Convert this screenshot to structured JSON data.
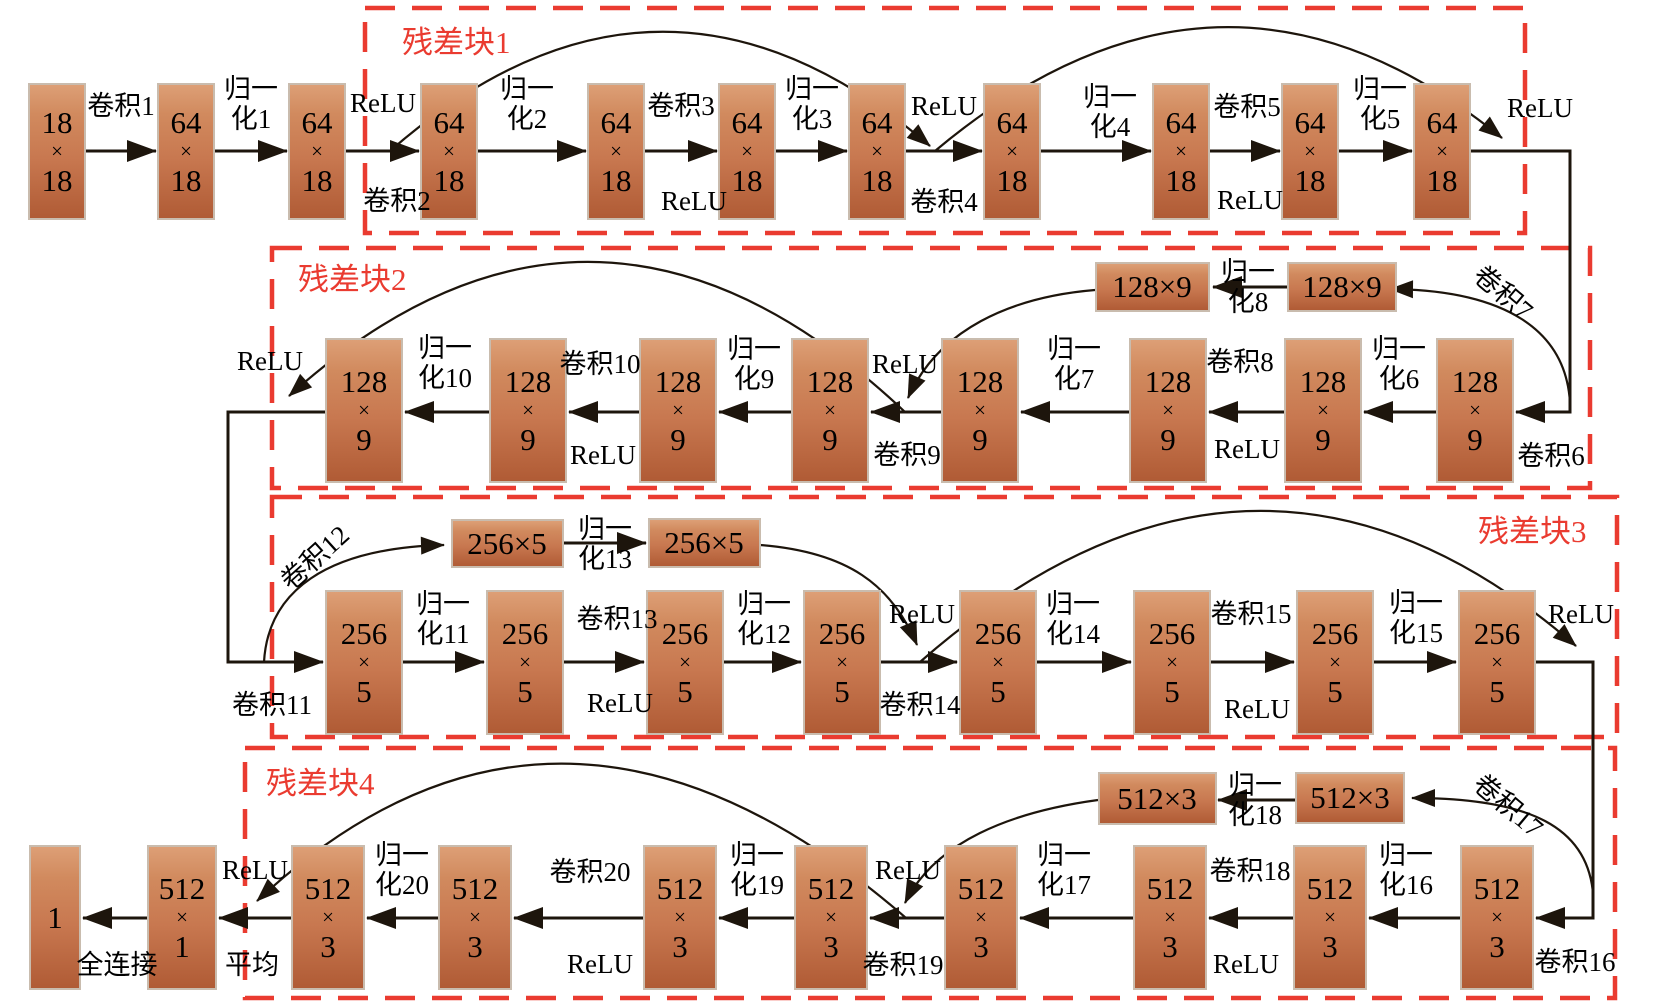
{
  "diagram": {
    "canvas": {
      "width": 1654,
      "height": 1004,
      "background": "#ffffff"
    },
    "colors": {
      "block_gradient_top": "#dd9f76",
      "block_gradient_bottom": "#b05b35",
      "residual_box_red": "#ea3b30",
      "wire_black": "#1d150c"
    },
    "boxes": [
      {
        "label": "残差块1",
        "x": 365,
        "y": 8,
        "w": 1160,
        "h": 225,
        "lx": 402,
        "ly": 27
      },
      {
        "label": "残差块2",
        "x": 272,
        "y": 248,
        "w": 1318,
        "h": 240,
        "lx": 298,
        "ly": 264
      },
      {
        "label": "残差块3",
        "x": 272,
        "y": 497,
        "w": 1345,
        "h": 240,
        "lx": 1478,
        "ly": 516
      },
      {
        "label": "残差块4",
        "x": 245,
        "y": 748,
        "w": 1370,
        "h": 250,
        "lx": 266,
        "ly": 768
      }
    ],
    "nodes": [
      {
        "lines": [
          "18",
          "×",
          "18"
        ],
        "cx": 57,
        "top": 83,
        "w": 58,
        "h": 137
      },
      {
        "lines": [
          "64",
          "×",
          "18"
        ],
        "cx": 186,
        "top": 83,
        "w": 58,
        "h": 137
      },
      {
        "lines": [
          "64",
          "×",
          "18"
        ],
        "cx": 317,
        "top": 83,
        "w": 58,
        "h": 137
      },
      {
        "lines": [
          "64",
          "×",
          "18"
        ],
        "cx": 449,
        "top": 83,
        "w": 58,
        "h": 137
      },
      {
        "lines": [
          "64",
          "×",
          "18"
        ],
        "cx": 616,
        "top": 83,
        "w": 58,
        "h": 137
      },
      {
        "lines": [
          "64",
          "×",
          "18"
        ],
        "cx": 747,
        "top": 83,
        "w": 58,
        "h": 137
      },
      {
        "lines": [
          "64",
          "×",
          "18"
        ],
        "cx": 877,
        "top": 83,
        "w": 58,
        "h": 137
      },
      {
        "lines": [
          "64",
          "×",
          "18"
        ],
        "cx": 1012,
        "top": 83,
        "w": 58,
        "h": 137
      },
      {
        "lines": [
          "64",
          "×",
          "18"
        ],
        "cx": 1181,
        "top": 83,
        "w": 58,
        "h": 137
      },
      {
        "lines": [
          "64",
          "×",
          "18"
        ],
        "cx": 1310,
        "top": 83,
        "w": 58,
        "h": 137
      },
      {
        "lines": [
          "64",
          "×",
          "18"
        ],
        "cx": 1442,
        "top": 83,
        "w": 58,
        "h": 137
      },
      {
        "lines": [
          "128",
          "×",
          "9"
        ],
        "cx": 364,
        "top": 338,
        "w": 78,
        "h": 145
      },
      {
        "lines": [
          "128",
          "×",
          "9"
        ],
        "cx": 528,
        "top": 338,
        "w": 78,
        "h": 145
      },
      {
        "lines": [
          "128",
          "×",
          "9"
        ],
        "cx": 678,
        "top": 338,
        "w": 78,
        "h": 145
      },
      {
        "lines": [
          "128",
          "×",
          "9"
        ],
        "cx": 830,
        "top": 338,
        "w": 78,
        "h": 145
      },
      {
        "lines": [
          "128",
          "×",
          "9"
        ],
        "cx": 980,
        "top": 338,
        "w": 78,
        "h": 145
      },
      {
        "lines": [
          "128",
          "×",
          "9"
        ],
        "cx": 1168,
        "top": 338,
        "w": 78,
        "h": 145
      },
      {
        "lines": [
          "128",
          "×",
          "9"
        ],
        "cx": 1323,
        "top": 338,
        "w": 78,
        "h": 145
      },
      {
        "lines": [
          "128",
          "×",
          "9"
        ],
        "cx": 1475,
        "top": 338,
        "w": 78,
        "h": 145
      },
      {
        "lines": [
          "128×9"
        ],
        "cx": 1152,
        "top": 262,
        "w": 115,
        "h": 50
      },
      {
        "lines": [
          "128×9"
        ],
        "cx": 1342,
        "top": 262,
        "w": 110,
        "h": 50
      },
      {
        "lines": [
          "256",
          "×",
          "5"
        ],
        "cx": 364,
        "top": 590,
        "w": 78,
        "h": 145
      },
      {
        "lines": [
          "256",
          "×",
          "5"
        ],
        "cx": 525,
        "top": 590,
        "w": 78,
        "h": 145
      },
      {
        "lines": [
          "256",
          "×",
          "5"
        ],
        "cx": 685,
        "top": 590,
        "w": 78,
        "h": 145
      },
      {
        "lines": [
          "256",
          "×",
          "5"
        ],
        "cx": 842,
        "top": 590,
        "w": 78,
        "h": 145
      },
      {
        "lines": [
          "256",
          "×",
          "5"
        ],
        "cx": 998,
        "top": 590,
        "w": 78,
        "h": 145
      },
      {
        "lines": [
          "256",
          "×",
          "5"
        ],
        "cx": 1172,
        "top": 590,
        "w": 78,
        "h": 145
      },
      {
        "lines": [
          "256",
          "×",
          "5"
        ],
        "cx": 1335,
        "top": 590,
        "w": 78,
        "h": 145
      },
      {
        "lines": [
          "256",
          "×",
          "5"
        ],
        "cx": 1497,
        "top": 590,
        "w": 78,
        "h": 145
      },
      {
        "lines": [
          "256×5"
        ],
        "cx": 507,
        "top": 519,
        "w": 113,
        "h": 49
      },
      {
        "lines": [
          "256×5"
        ],
        "cx": 704,
        "top": 518,
        "w": 113,
        "h": 50
      },
      {
        "lines": [
          "1"
        ],
        "cx": 55,
        "top": 845,
        "w": 52,
        "h": 145
      },
      {
        "lines": [
          "512",
          "×",
          "1"
        ],
        "cx": 182,
        "top": 845,
        "w": 70,
        "h": 145
      },
      {
        "lines": [
          "512",
          "×",
          "3"
        ],
        "cx": 328,
        "top": 845,
        "w": 74,
        "h": 145
      },
      {
        "lines": [
          "512",
          "×",
          "3"
        ],
        "cx": 475,
        "top": 845,
        "w": 74,
        "h": 145
      },
      {
        "lines": [
          "512",
          "×",
          "3"
        ],
        "cx": 680,
        "top": 845,
        "w": 74,
        "h": 145
      },
      {
        "lines": [
          "512",
          "×",
          "3"
        ],
        "cx": 831,
        "top": 845,
        "w": 74,
        "h": 145
      },
      {
        "lines": [
          "512",
          "×",
          "3"
        ],
        "cx": 981,
        "top": 845,
        "w": 74,
        "h": 145
      },
      {
        "lines": [
          "512",
          "×",
          "3"
        ],
        "cx": 1170,
        "top": 845,
        "w": 74,
        "h": 145
      },
      {
        "lines": [
          "512",
          "×",
          "3"
        ],
        "cx": 1330,
        "top": 845,
        "w": 74,
        "h": 145
      },
      {
        "lines": [
          "512",
          "×",
          "3"
        ],
        "cx": 1497,
        "top": 845,
        "w": 74,
        "h": 145
      },
      {
        "lines": [
          "512×3"
        ],
        "cx": 1157,
        "top": 772,
        "w": 119,
        "h": 53
      },
      {
        "lines": [
          "512×3"
        ],
        "cx": 1350,
        "top": 772,
        "w": 110,
        "h": 52
      }
    ],
    "labels": [
      {
        "lines": [
          "卷积1"
        ],
        "x": 121,
        "y": 106
      },
      {
        "lines": [
          "归一",
          "化1"
        ],
        "x": 251,
        "y": 104
      },
      {
        "lines": [
          "ReLU"
        ],
        "x": 383,
        "y": 103
      },
      {
        "lines": [
          "卷积2"
        ],
        "x": 397,
        "y": 201
      },
      {
        "lines": [
          "归一",
          "化2"
        ],
        "x": 527,
        "y": 104
      },
      {
        "lines": [
          "卷积3"
        ],
        "x": 681,
        "y": 106
      },
      {
        "lines": [
          "ReLU"
        ],
        "x": 694,
        "y": 201
      },
      {
        "lines": [
          "归一",
          "化3"
        ],
        "x": 812,
        "y": 104
      },
      {
        "lines": [
          "ReLU"
        ],
        "x": 944,
        "y": 106
      },
      {
        "lines": [
          "卷积4"
        ],
        "x": 944,
        "y": 202
      },
      {
        "lines": [
          "归一",
          "化4"
        ],
        "x": 1110,
        "y": 112
      },
      {
        "lines": [
          "卷积5"
        ],
        "x": 1247,
        "y": 107
      },
      {
        "lines": [
          "ReLU"
        ],
        "x": 1250,
        "y": 200
      },
      {
        "lines": [
          "归一",
          "化5"
        ],
        "x": 1380,
        "y": 104
      },
      {
        "lines": [
          "ReLU"
        ],
        "x": 1540,
        "y": 108
      },
      {
        "lines": [
          "卷积6"
        ],
        "x": 1551,
        "y": 456
      },
      {
        "lines": [
          "归一",
          "化6"
        ],
        "x": 1399,
        "y": 364
      },
      {
        "lines": [
          "卷积8"
        ],
        "x": 1240,
        "y": 362
      },
      {
        "lines": [
          "ReLU"
        ],
        "x": 1247,
        "y": 449
      },
      {
        "lines": [
          "归一",
          "化7"
        ],
        "x": 1074,
        "y": 364
      },
      {
        "lines": [
          "ReLU"
        ],
        "x": 905,
        "y": 364
      },
      {
        "lines": [
          "卷积9"
        ],
        "x": 907,
        "y": 455
      },
      {
        "lines": [
          "归一",
          "化9"
        ],
        "x": 754,
        "y": 364
      },
      {
        "lines": [
          "卷积10"
        ],
        "x": 600,
        "y": 364
      },
      {
        "lines": [
          "ReLU"
        ],
        "x": 603,
        "y": 455
      },
      {
        "lines": [
          "归一",
          "化10"
        ],
        "x": 445,
        "y": 363
      },
      {
        "lines": [
          "ReLU"
        ],
        "x": 270,
        "y": 361
      },
      {
        "lines": [
          "归一",
          "化8"
        ],
        "x": 1248,
        "y": 287
      },
      {
        "lines": [
          "卷积7"
        ],
        "x": 1503,
        "y": 293,
        "rot": 40
      },
      {
        "lines": [
          "卷积11"
        ],
        "x": 272,
        "y": 705
      },
      {
        "lines": [
          "卷积12"
        ],
        "x": 315,
        "y": 558,
        "rot": -42
      },
      {
        "lines": [
          "归一",
          "化13"
        ],
        "x": 605,
        "y": 544
      },
      {
        "lines": [
          "归一",
          "化11"
        ],
        "x": 443,
        "y": 619
      },
      {
        "lines": [
          "卷积13"
        ],
        "x": 617,
        "y": 619
      },
      {
        "lines": [
          "ReLU"
        ],
        "x": 620,
        "y": 703
      },
      {
        "lines": [
          "归一",
          "化12"
        ],
        "x": 764,
        "y": 619
      },
      {
        "lines": [
          "ReLU"
        ],
        "x": 922,
        "y": 614
      },
      {
        "lines": [
          "卷积14"
        ],
        "x": 920,
        "y": 705
      },
      {
        "lines": [
          "归一",
          "化14"
        ],
        "x": 1073,
        "y": 619
      },
      {
        "lines": [
          "卷积15"
        ],
        "x": 1251,
        "y": 614
      },
      {
        "lines": [
          "ReLU"
        ],
        "x": 1257,
        "y": 709
      },
      {
        "lines": [
          "归一",
          "化15"
        ],
        "x": 1416,
        "y": 618
      },
      {
        "lines": [
          "ReLU"
        ],
        "x": 1581,
        "y": 614
      },
      {
        "lines": [
          "卷积16"
        ],
        "x": 1575,
        "y": 962
      },
      {
        "lines": [
          "卷积17"
        ],
        "x": 1508,
        "y": 806,
        "rot": 40
      },
      {
        "lines": [
          "归一",
          "化18"
        ],
        "x": 1255,
        "y": 800
      },
      {
        "lines": [
          "归一",
          "化16"
        ],
        "x": 1406,
        "y": 870
      },
      {
        "lines": [
          "卷积18"
        ],
        "x": 1250,
        "y": 871
      },
      {
        "lines": [
          "ReLU"
        ],
        "x": 1246,
        "y": 964
      },
      {
        "lines": [
          "归一",
          "化17"
        ],
        "x": 1064,
        "y": 870
      },
      {
        "lines": [
          "ReLU"
        ],
        "x": 908,
        "y": 870
      },
      {
        "lines": [
          "卷积19"
        ],
        "x": 903,
        "y": 965
      },
      {
        "lines": [
          "归一",
          "化19"
        ],
        "x": 757,
        "y": 870
      },
      {
        "lines": [
          "卷积20"
        ],
        "x": 590,
        "y": 872
      },
      {
        "lines": [
          "ReLU"
        ],
        "x": 600,
        "y": 964
      },
      {
        "lines": [
          "归一",
          "化20"
        ],
        "x": 402,
        "y": 870
      },
      {
        "lines": [
          "ReLU"
        ],
        "x": 255,
        "y": 870
      },
      {
        "lines": [
          "平均"
        ],
        "x": 252,
        "y": 965
      },
      {
        "lines": [
          "全连接"
        ],
        "x": 117,
        "y": 965
      }
    ],
    "edges": [
      {
        "d": "M86 151 L156 151"
      },
      {
        "d": "M215 151 L287 151"
      },
      {
        "d": "M346 151 L419 151"
      },
      {
        "d": "M478 151 L586 151"
      },
      {
        "d": "M645 151 L717 151"
      },
      {
        "d": "M776 151 L847 151"
      },
      {
        "d": "M906 151 L982 151"
      },
      {
        "d": "M1041 151 L1151 151"
      },
      {
        "d": "M1210 151 L1280 151"
      },
      {
        "d": "M1339 151 L1412 151"
      },
      {
        "d": "M1471 151 L1570 151 L1570 412 L1516 412"
      },
      {
        "d": "M1436 412 L1364 412"
      },
      {
        "d": "M1284 412 L1209 412"
      },
      {
        "d": "M1129 412 L1021 412"
      },
      {
        "d": "M941 412 L871 412"
      },
      {
        "d": "M791 412 L719 412"
      },
      {
        "d": "M639 412 L569 412"
      },
      {
        "d": "M489 412 L405 412"
      },
      {
        "d": "M325 412 L228 412 L228 662 L323 662"
      },
      {
        "d": "M403 662 L484 662"
      },
      {
        "d": "M564 662 L644 662"
      },
      {
        "d": "M724 662 L801 662"
      },
      {
        "d": "M881 662 L957 662"
      },
      {
        "d": "M1037 662 L1131 662"
      },
      {
        "d": "M1211 662 L1294 662"
      },
      {
        "d": "M1374 662 L1456 662"
      },
      {
        "d": "M1536 662 L1593 662 L1593 918 L1536 918"
      },
      {
        "d": "M1460 918 L1369 918"
      },
      {
        "d": "M1293 918 L1209 918"
      },
      {
        "d": "M1133 918 L1020 918"
      },
      {
        "d": "M944 918 L870 918"
      },
      {
        "d": "M794 918 L719 918"
      },
      {
        "d": "M643 918 L514 918"
      },
      {
        "d": "M438 918 L367 918"
      },
      {
        "d": "M291 918 L219 918"
      },
      {
        "d": "M147 918 L83 918"
      },
      {
        "d": "M1287 287 L1213 287"
      },
      {
        "d": "M563 543 L646 543"
      },
      {
        "d": "M1295 800 L1218 800"
      },
      {
        "d": "M390 151 Q660 -85 930 146",
        "thin": true
      },
      {
        "d": "M935 151 Q1222 -90 1502 138",
        "thin": true
      },
      {
        "d": "M1570 403 C1566 330 1505 290 1390 289",
        "thin": true
      },
      {
        "d": "M1095 290 C1010 297 938 330 908 398",
        "thin": true
      },
      {
        "d": "M905 412 Q596 120 289 396",
        "thin": true
      },
      {
        "d": "M264 662 C268 592 325 548 444 545",
        "thin": true
      },
      {
        "d": "M760 545 C848 552 892 585 917 645",
        "thin": true
      },
      {
        "d": "M920 662 Q1255 368 1576 646",
        "thin": true
      },
      {
        "d": "M1593 893 C1587 828 1532 798 1412 798",
        "thin": true
      },
      {
        "d": "M1098 800 C1010 812 935 842 905 903",
        "thin": true
      },
      {
        "d": "M906 918 Q560 618 257 901",
        "thin": true
      }
    ]
  }
}
